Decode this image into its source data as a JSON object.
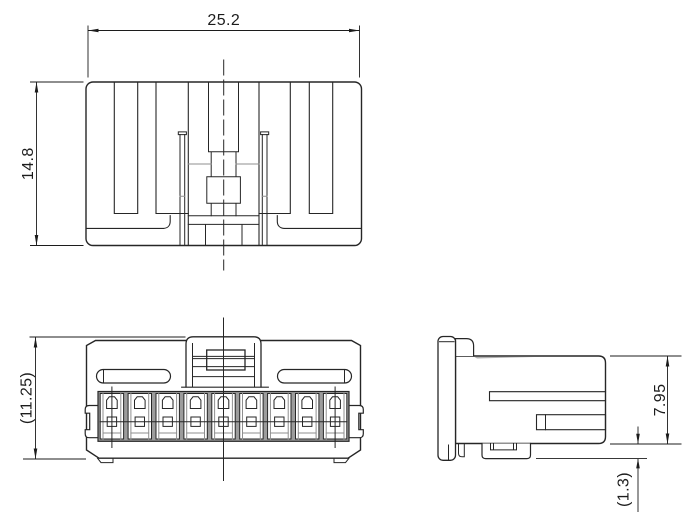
{
  "drawing": {
    "kind": "engineering-drawing",
    "subject": "9-position connector housing, three orthographic views",
    "views": {
      "top": {
        "id": "top-view"
      },
      "front": {
        "id": "front-view",
        "cavity_count": 9
      },
      "side": {
        "id": "side-view"
      }
    },
    "dimensions": {
      "width": {
        "label": "25.2"
      },
      "height": {
        "label": "14.8"
      },
      "front_height": {
        "label": "(11.25)"
      },
      "side_height": {
        "label": "7.95"
      },
      "lock_offset": {
        "label": "(1.3)"
      }
    },
    "colors": {
      "line": "#262626",
      "gray_line": "#8f8f8f",
      "wall_fill": "#9c9c9c",
      "background": "#ffffff"
    }
  }
}
